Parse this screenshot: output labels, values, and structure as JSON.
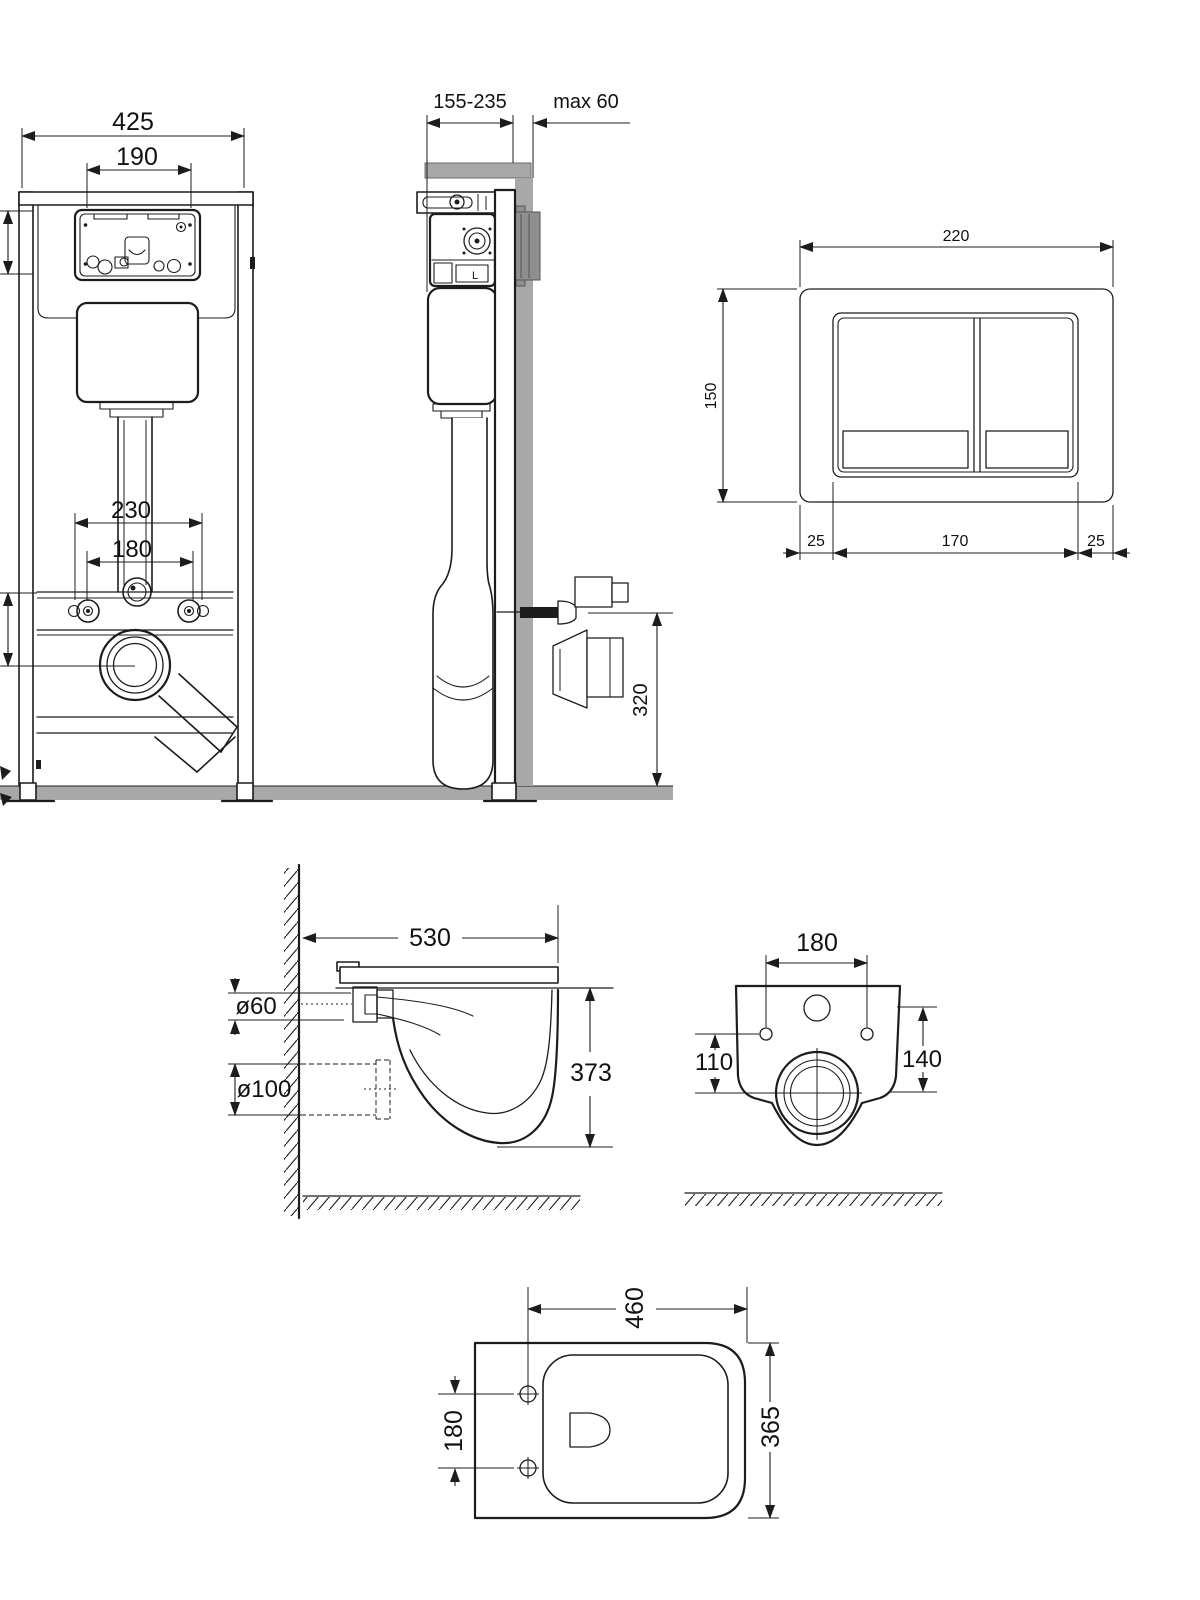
{
  "drawing": {
    "frame_front": {
      "width": "425",
      "access_width": "190",
      "bolt_span": "230",
      "bolt_inner_span": "180"
    },
    "frame_side": {
      "depth_range": "155-235",
      "wall_max": "max 60",
      "outlet_height": "320",
      "valve_mark": "L"
    },
    "flush_plate": {
      "width": "220",
      "height": "150",
      "margin_left": "25",
      "buttons_width": "170",
      "margin_right": "25"
    },
    "bowl_side": {
      "length": "530",
      "inlet_diameter": "ø60",
      "outlet_diameter": "ø100",
      "height": "373"
    },
    "bowl_rear": {
      "hole_span": "180",
      "outlet_offset": "110",
      "inlet_offset": "140"
    },
    "bowl_plan": {
      "length": "460",
      "hole_span": "180",
      "width": "365"
    }
  },
  "colors": {
    "line": "#1c1c1c",
    "gray": "#a8a8a8",
    "gray_dark": "#8f8f8f"
  }
}
